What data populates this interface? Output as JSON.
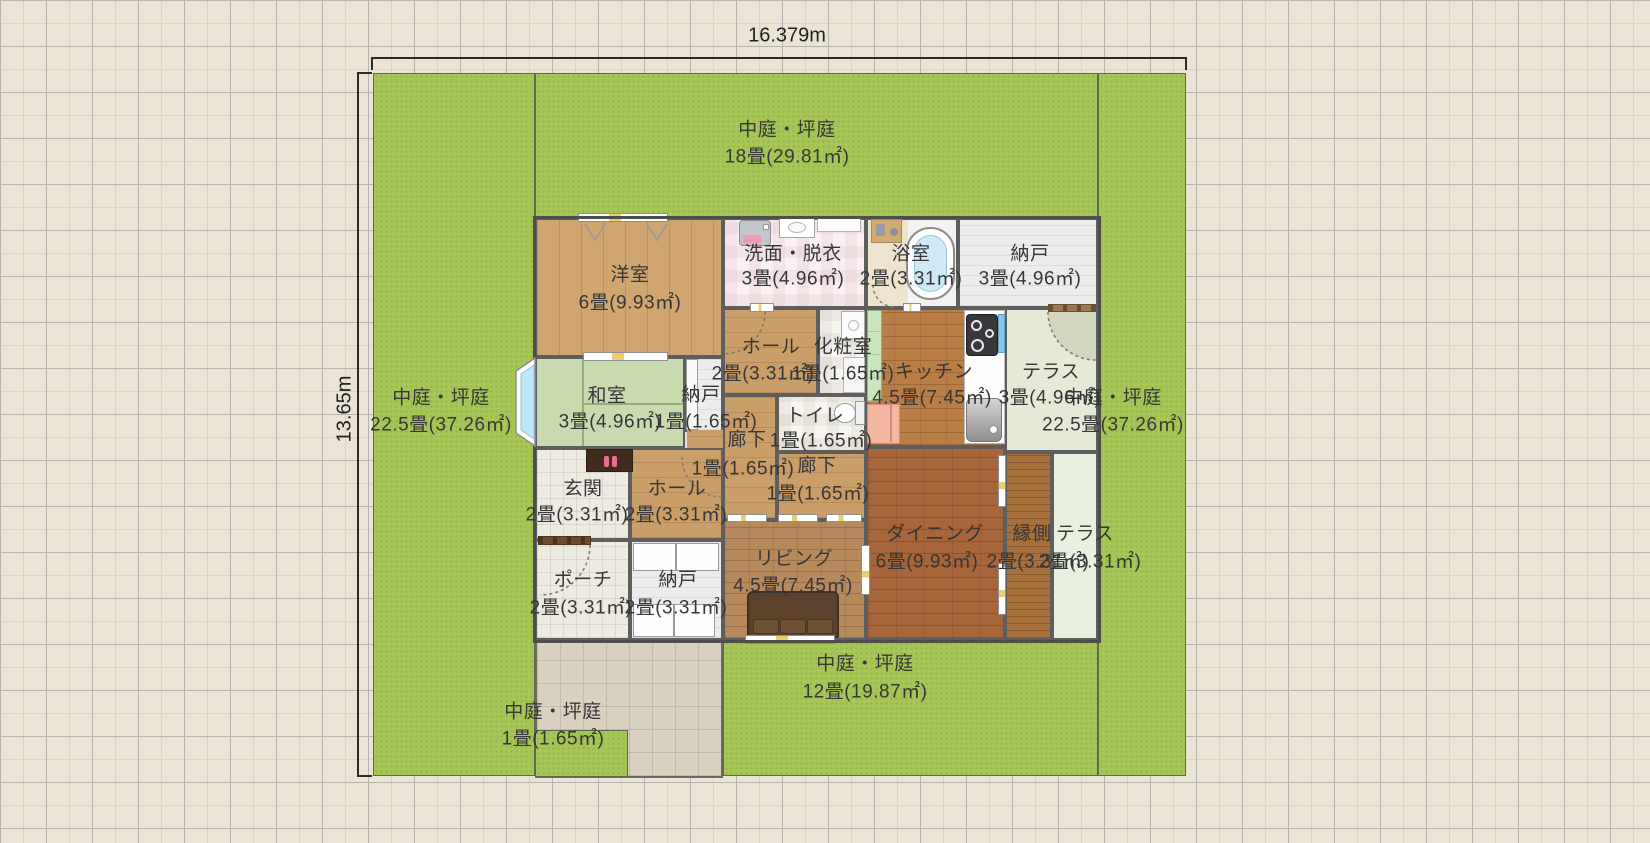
{
  "dimensions": {
    "width_label": "16.379m",
    "height_label": "13.65m"
  },
  "palette": {
    "garden_green": "#a6c657",
    "wall_gray": "#5e5e5e",
    "background_beige": "#ebe4d4"
  },
  "gardens": {
    "top": {
      "name": "中庭・坪庭",
      "area": "18畳(29.81㎡)"
    },
    "left": {
      "name": "中庭・坪庭",
      "area": "22.5畳(37.26㎡)"
    },
    "right": {
      "name": "中庭・坪庭",
      "area": "22.5畳(37.26㎡)"
    },
    "bottom": {
      "name": "中庭・坪庭",
      "area": "12畳(19.87㎡)"
    },
    "small": {
      "name": "中庭・坪庭",
      "area": "1畳(1.65㎡)"
    }
  },
  "rooms": {
    "yoshitsu": {
      "name": "洋室",
      "area": "6畳(9.93㎡)"
    },
    "senmen": {
      "name": "洗面・脱衣",
      "area": "3畳(4.96㎡)"
    },
    "yokushitsu": {
      "name": "浴室",
      "area": "2畳(3.31㎡)"
    },
    "nando_top": {
      "name": "納戸",
      "area": "3畳(4.96㎡)"
    },
    "washitsu": {
      "name": "和室",
      "area": "3畳(4.96㎡)"
    },
    "nando_mid": {
      "name": "納戸",
      "area": "1畳(1.65㎡)"
    },
    "hall_upper": {
      "name": "ホール",
      "area": "2畳(3.31㎡)"
    },
    "keshoshitsu": {
      "name": "化粧室",
      "area": "1畳(1.65㎡)"
    },
    "kitchen": {
      "name": "キッチン",
      "area": "4.5畳(7.45㎡)"
    },
    "terrace_kitchen": {
      "name": "テラス",
      "area": "3畳(4.96㎡)"
    },
    "toilet": {
      "name": "トイレ",
      "area": "1畳(1.65㎡)"
    },
    "roka_a": {
      "name": "廊下",
      "area": "1畳(1.65㎡)"
    },
    "roka_b": {
      "name": "廊下",
      "area": "1畳(1.65㎡)"
    },
    "genkan": {
      "name": "玄関",
      "area": "2畳(3.31㎡)"
    },
    "hall_lower": {
      "name": "ホール",
      "area": "2畳(3.31㎡)"
    },
    "living": {
      "name": "リビング",
      "area": "4.5畳(7.45㎡)"
    },
    "dining": {
      "name": "ダイニング",
      "area": "6畳(9.93㎡)"
    },
    "engawa": {
      "name": "縁側",
      "area": "2畳(3.31㎡)"
    },
    "terrace_engawa": {
      "name": "テラス",
      "area": "2畳(3.31㎡)"
    },
    "porch": {
      "name": "ポーチ",
      "area": "2畳(3.31㎡)"
    },
    "nando_bottom": {
      "name": "納戸",
      "area": "2畳(3.31㎡)"
    }
  }
}
